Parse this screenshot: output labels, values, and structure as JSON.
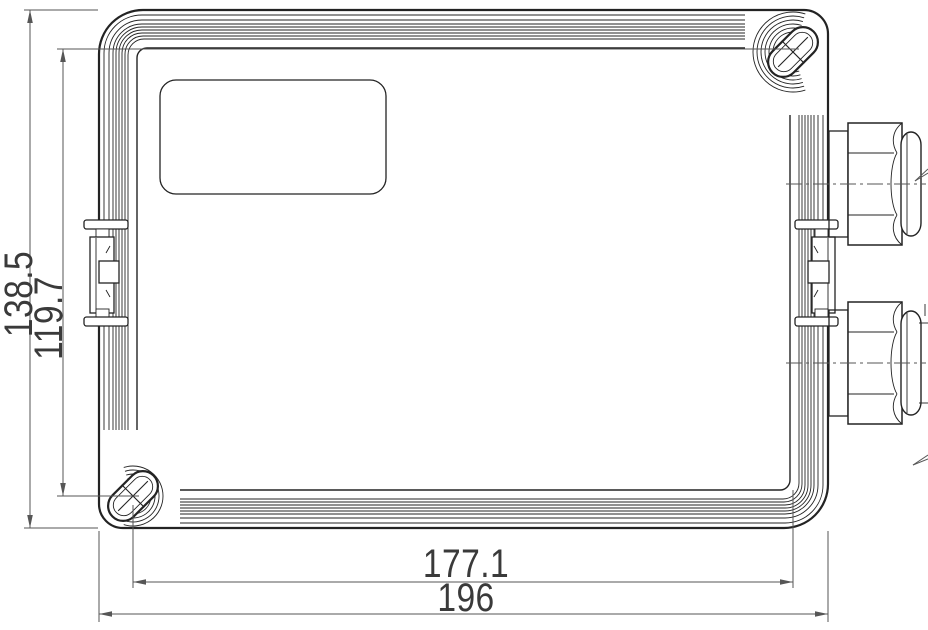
{
  "drawing": {
    "kind": "technical-drawing",
    "view": "enclosure front view with cable glands",
    "background": "#ffffff",
    "line_color": "#232323",
    "dimension_color": "#565656",
    "text_color": "#3a3a3a"
  },
  "dimensions": {
    "overall_height": "138.5",
    "mount_hole_spacing_vertical": "119.7",
    "mount_hole_spacing_horizontal": "177.1",
    "overall_width": "196"
  },
  "parts": {
    "enclosure": "enclosure-lid",
    "label_area": "nameplate-recess",
    "screw_top_right": "mounting-screw-slot",
    "screw_bottom_left": "mounting-screw-slot",
    "gland_top": "cable-gland",
    "gland_bottom": "cable-gland",
    "hinge_left": "lid-latch",
    "hinge_right": "lid-latch"
  }
}
